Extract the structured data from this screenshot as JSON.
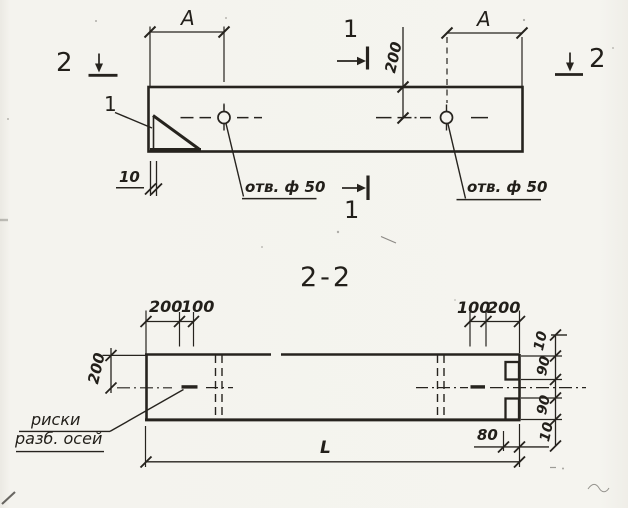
{
  "meta": {
    "drawing_type": "scanned construction drawing",
    "paper_color": "#f4f3ee",
    "ink_color": "#26231e"
  },
  "plan_view": {
    "section_marker_2_left": "2",
    "section_marker_2_right": "2",
    "section_marker_1_top": "1",
    "section_marker_1_bottom": "1",
    "dim_a_left": "A",
    "dim_a_right": "A",
    "dim_200_vertical": "200",
    "dim_10_bottom_left": "10",
    "detail_ref": "1",
    "hole_label_left": "отв. ф 50",
    "hole_label_right": "отв. ф 50"
  },
  "section_view": {
    "title": "2-2",
    "dims_top_left": [
      "200",
      "100"
    ],
    "dims_top_right": [
      "100",
      "200"
    ],
    "dim_left_vertical": "200",
    "dims_right_vertical": [
      "10",
      "90",
      "90",
      "10"
    ],
    "dim_total_length": "L",
    "dim_80": "80",
    "axis_note_line1": "риски",
    "axis_note_line2": "разб. осей"
  }
}
